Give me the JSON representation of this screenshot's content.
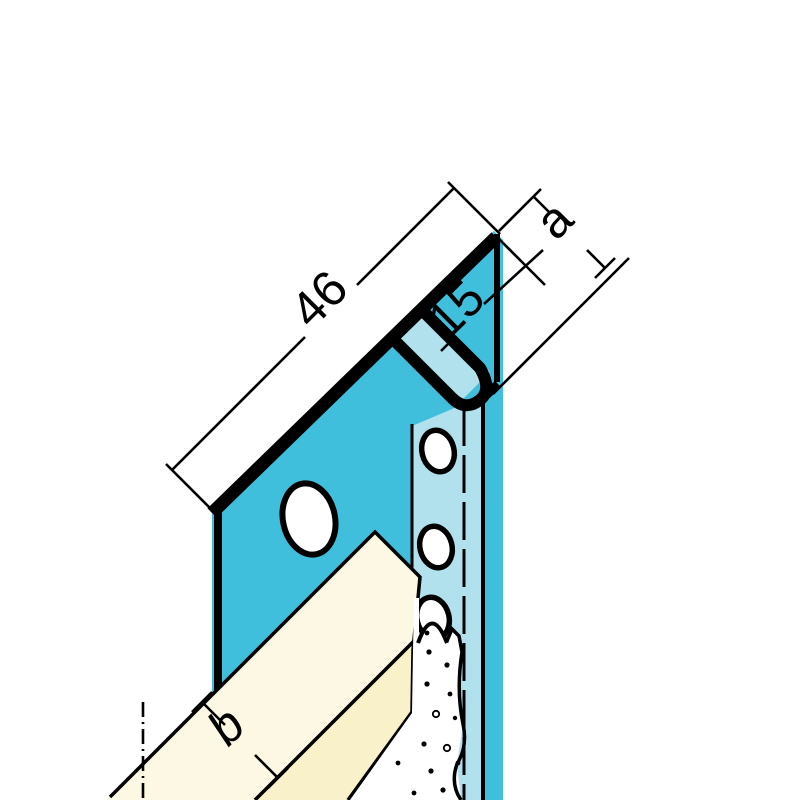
{
  "drawing": {
    "labels": {
      "flange_width": "46",
      "fold_depth": "15",
      "dim_a": "a",
      "dim_b": "b"
    },
    "colors": {
      "profile": "#3FBFDB",
      "profile_light": "#B2E1EE",
      "board_top": "#FCF8E3",
      "board_front": "#F8F1C9",
      "line": "#000000",
      "background": "#FFFFFF"
    }
  }
}
